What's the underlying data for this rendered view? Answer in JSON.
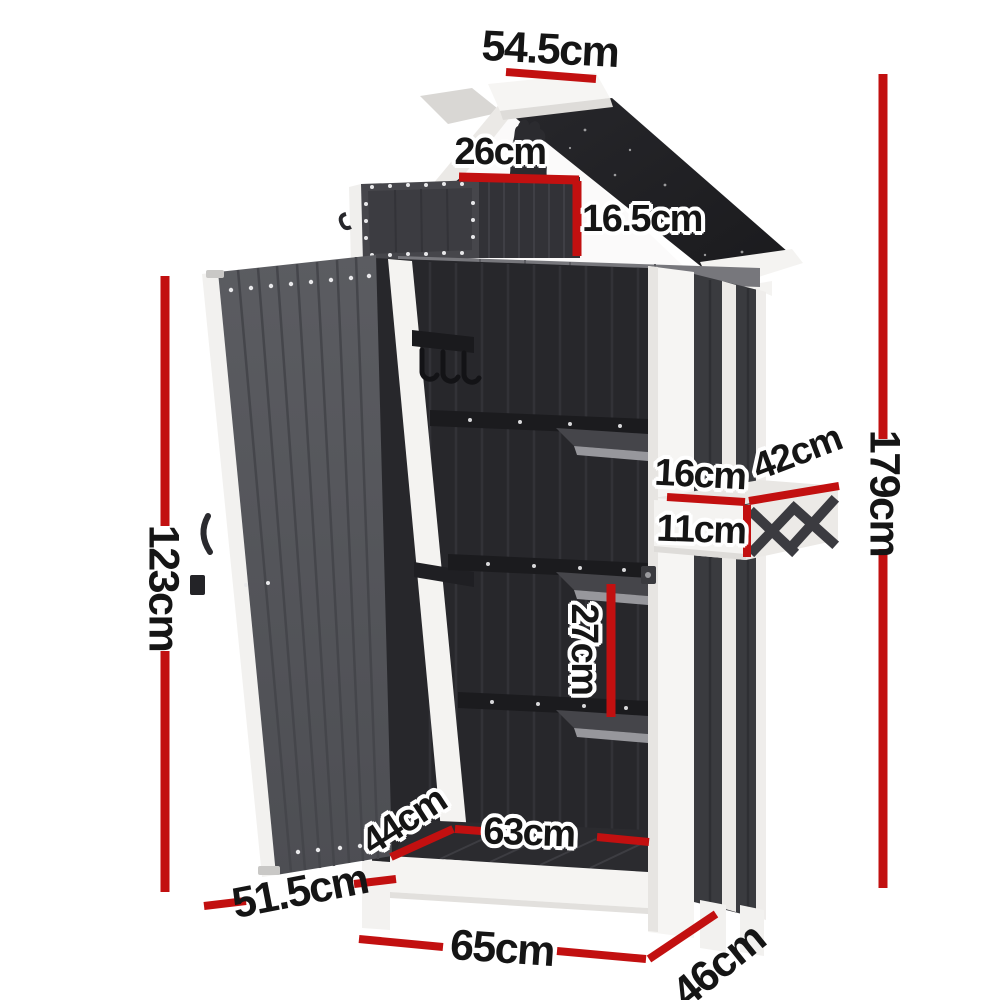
{
  "colors": {
    "accent_red": "#c21010",
    "panel_dark": "#3c3d41",
    "interior_dark": "#27272b",
    "frame_white": "#f5f4f2",
    "roof_black": "#1f1f22"
  },
  "dims": {
    "roof_width": "54.5cm",
    "niche_width": "26cm",
    "niche_height": "16.5cm",
    "door_height": "123cm",
    "overall_height": "179cm",
    "planter_depth": "16cm",
    "planter_width": "42cm",
    "planter_height": "11cm",
    "shelf_gap": "27cm",
    "floor_depth": "44cm",
    "floor_width": "63cm",
    "door_width": "51.5cm",
    "base_width": "65cm",
    "base_depth": "46cm"
  }
}
